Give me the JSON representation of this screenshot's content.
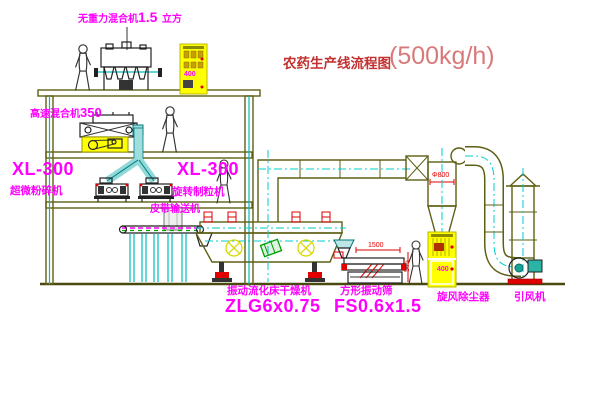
{
  "title": {
    "name": "农药生产线流程图",
    "capacity": "(500kg/h)"
  },
  "equipment": {
    "gravity_mixer": {
      "pre": "无重力混合机",
      "num": "1.5",
      "post": "立方"
    },
    "high_speed_mixer": {
      "pre": "高速混合机",
      "num": "350"
    },
    "left_unit": {
      "model": "XL-300",
      "name": "超微粉碎机"
    },
    "granulator": {
      "model": "XL-300",
      "name": "旋转制粒机"
    },
    "belt_conveyor": {
      "name": "皮带输送机"
    },
    "fluid_bed_dryer": {
      "name": "振动流化床干燥机",
      "model": "ZLG6x0.75"
    },
    "vibrating_sieve": {
      "name": "方形振动筛",
      "model": "FS0.6x1.5"
    },
    "cyclone": {
      "name": "旋风除尘器"
    },
    "induced_draft_fan": {
      "name": "引风机"
    }
  },
  "dimensions": {
    "sieve_length": "1500",
    "sieve_height": "545",
    "cyclone_dia": "Φ800",
    "cabinet_top": "400",
    "cabinet_bottom": "400"
  },
  "colors": {
    "label_magenta": "#ff00ff",
    "title_red": "#c23030",
    "title_light_red": "#d97a7a",
    "line_olive": "#5f5f14",
    "centerline_cyan": "#00cccc",
    "accent_red": "#e00000",
    "cabinet_yellow": "#ffff00",
    "logo_green": "#00a000"
  }
}
